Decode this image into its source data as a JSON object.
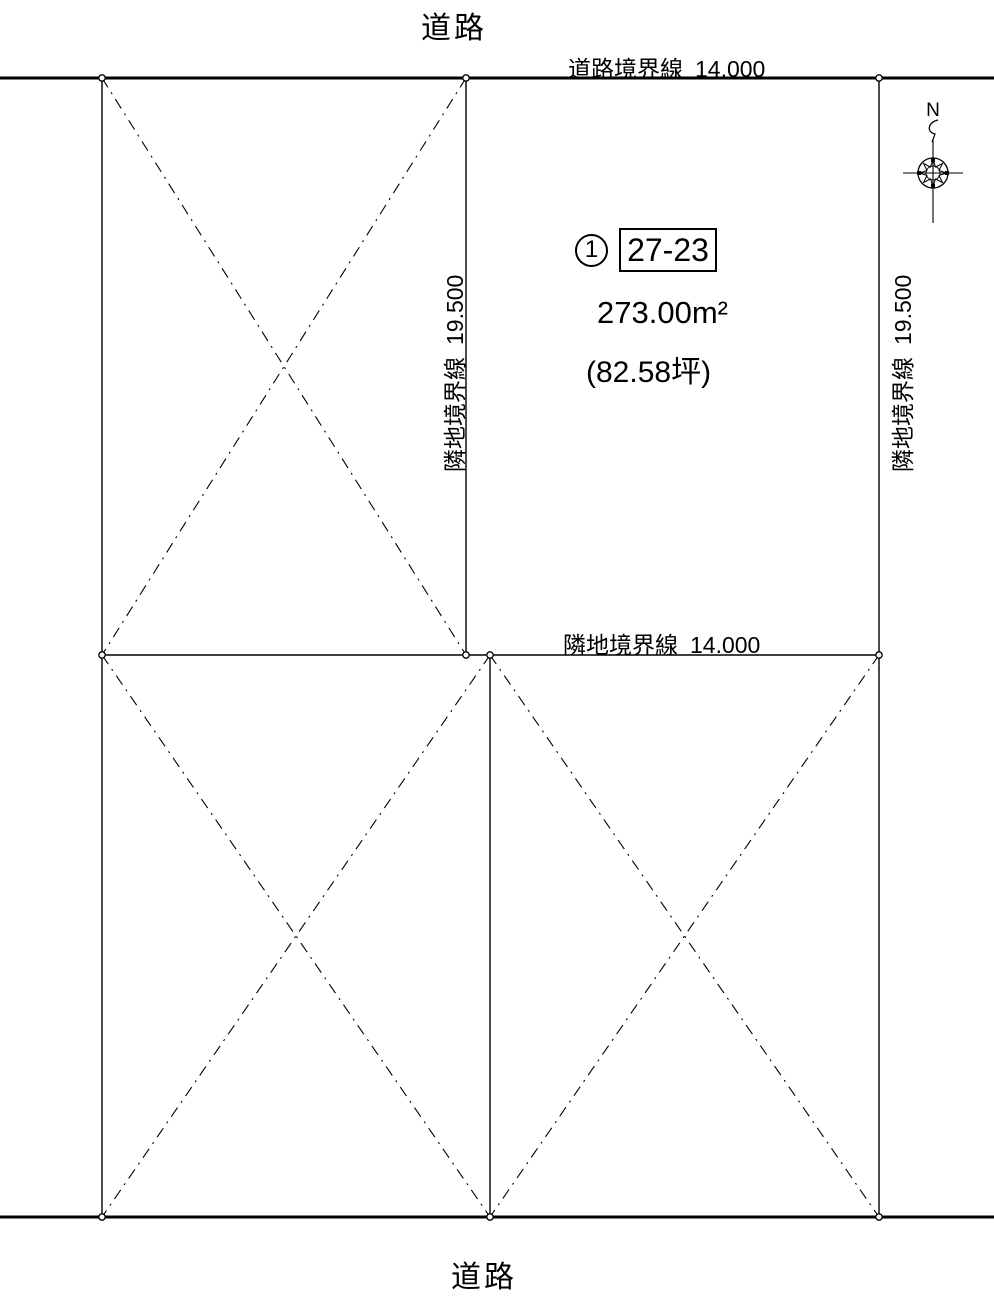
{
  "plan": {
    "road_top": "道路",
    "road_bottom": "道路",
    "boundaries": {
      "top": {
        "name": "道路境界線",
        "length": "14.000"
      },
      "middle": {
        "name": "隣地境界線",
        "length": "14.000"
      },
      "left": {
        "name": "隣地境界線",
        "length": "19.500"
      },
      "right": {
        "name": "隣地境界線",
        "length": "19.500"
      }
    },
    "lot": {
      "number": "1",
      "code": "27-23",
      "area_m2": "273.00m²",
      "area_tsubo": "(82.58坪)"
    },
    "compass": {
      "north_label": "N"
    },
    "colors": {
      "line": "#000000",
      "background": "#ffffff"
    }
  }
}
